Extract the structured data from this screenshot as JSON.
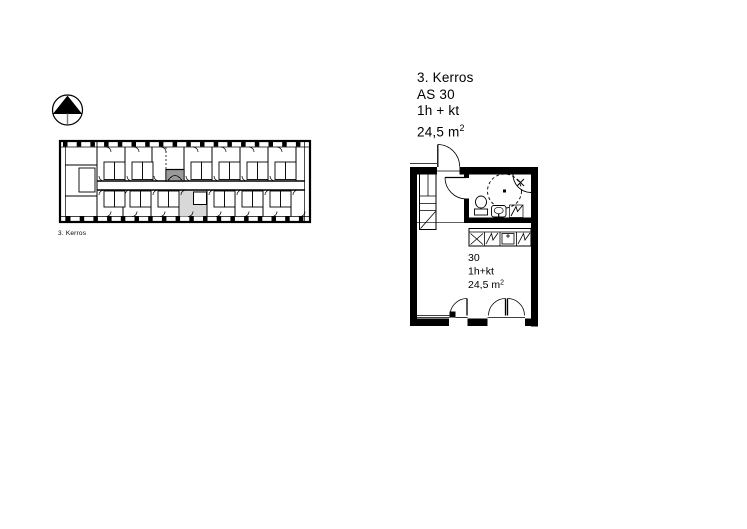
{
  "colors": {
    "line": "#000000",
    "highlight": "#d8d8d8",
    "background": "#ffffff"
  },
  "overview": {
    "floor_label": "3. Kerros"
  },
  "info_block": {
    "floor": "3. Kerros",
    "apartment": "AS 30",
    "rooms": "1h + kt",
    "area": "24,5 m",
    "area_sup": "2"
  },
  "apartment_plan": {
    "number": "30",
    "rooms": "1h+kt",
    "area": "24,5 m",
    "area_sup": "2"
  }
}
